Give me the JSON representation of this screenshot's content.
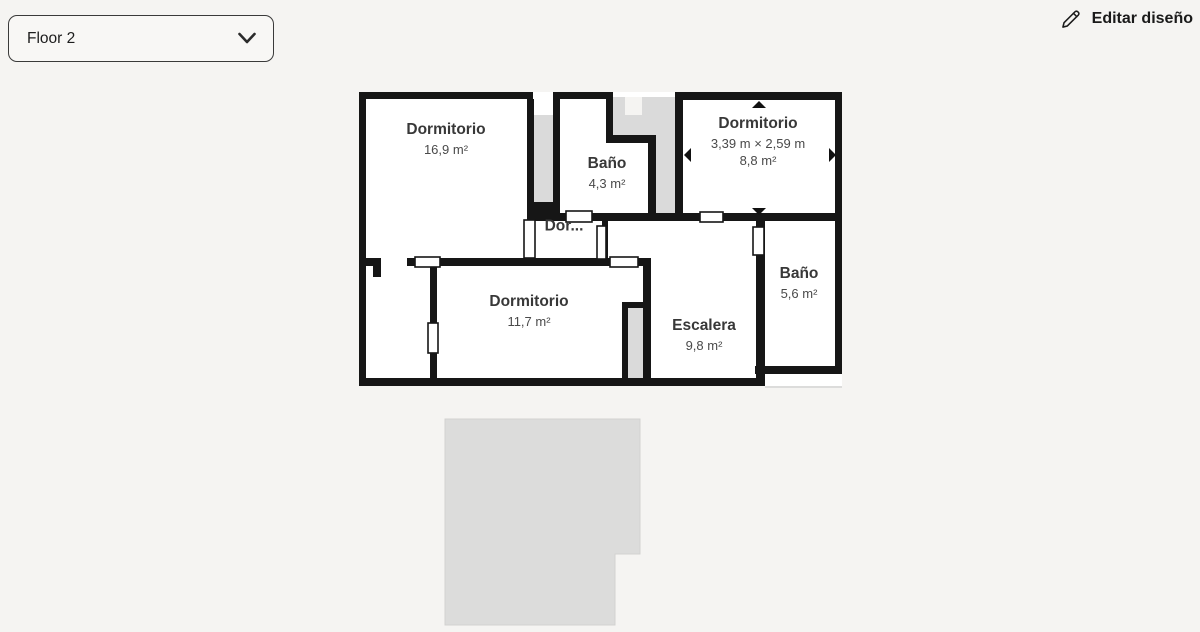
{
  "header": {
    "floor_selector": {
      "value": "Floor 2",
      "icon": "chevron-down"
    },
    "edit_button": {
      "label": "Editar diseño",
      "icon": "pencil"
    }
  },
  "floor_plan": {
    "rooms": [
      {
        "name": "Dormitorio",
        "area": "16,9 m²"
      },
      {
        "name": "Baño",
        "area": "4,3 m²"
      },
      {
        "name": "Dormitorio",
        "dimensions": "3,39 m × 2,59 m",
        "area": "8,8 m²",
        "selected": true
      },
      {
        "name": "Dor...",
        "truncated": true
      },
      {
        "name": "Dormitorio",
        "area": "11,7 m²"
      },
      {
        "name": "Escalera",
        "area": "9,8 m²"
      },
      {
        "name": "Baño",
        "area": "5,6 m²"
      }
    ]
  },
  "colors": {
    "background": "#f5f4f2",
    "walls": "#161616",
    "room_fill": "#ffffff",
    "unassigned_area": "#dadada",
    "lower_floor_silhouette": "#dcdcdb",
    "text_primary": "#383838",
    "text_secondary": "#4a4a4a"
  }
}
